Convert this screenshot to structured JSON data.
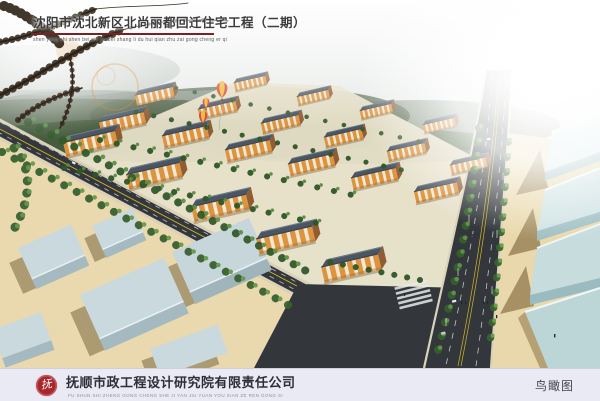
{
  "header": {
    "title": "沈阳市沈北新区北尚丽都回迁住宅工程（二期）",
    "title_pinyin": "shen yang shi shen bei xin qu bei shang li du hui qian zhu zai gong cheng er qi"
  },
  "footer": {
    "logo_glyph": "抚",
    "company_name": "抚顺市政工程设计研究院有限责任公司",
    "company_pinyin": "FU SHUN SHI ZHENG GONG CHENG SHE JI YAN JIU YUAN YOU XIAN ZE REN GONG SI",
    "view_label": "鸟瞰图"
  },
  "colors": {
    "title_text": "#3c3c3c",
    "title_underline": "#7a2023",
    "footer_bg": "#eaeaf4",
    "logo_red": "#a8272d",
    "company_text": "#2e2e38",
    "pinyin_gray": "#8f8f9c",
    "road_asphalt": "#33373b",
    "road_center_yellow": "#d2b52a",
    "building_facade": "#dc9440",
    "building_roof": "#4b5664",
    "tree_green": "#3a6130",
    "sand": "#ead9ae",
    "warehouse_west": "#c9d9de",
    "warehouse_east": "#bcd6d8"
  }
}
